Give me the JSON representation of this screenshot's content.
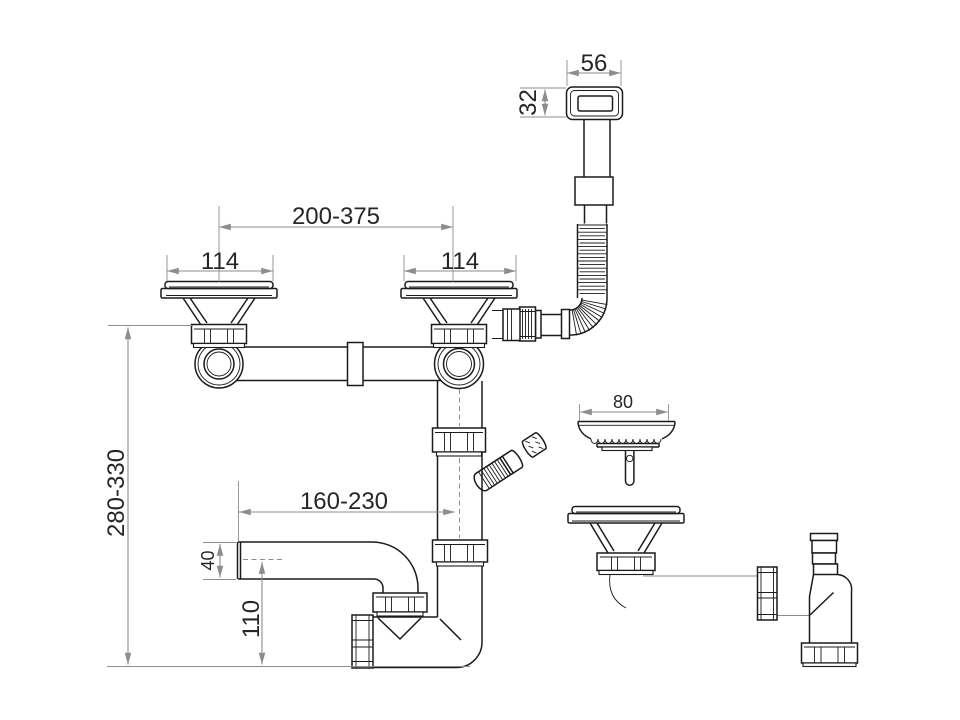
{
  "dimensions": {
    "overflow_width": "56",
    "overflow_height": "32",
    "drain_spacing": "200-375",
    "left_drain_flange": "114",
    "right_drain_flange": "114",
    "installation_height": "280-330",
    "outlet_offset": "160-230",
    "outlet_pipe_diameter": "40",
    "outlet_centerline_height": "110",
    "basket_diameter": "80"
  },
  "colors": {
    "background": "#ffffff",
    "part_outline": "#1b1b1b",
    "dimension_lines": "#8d8d8d",
    "dimension_text": "#262626"
  }
}
